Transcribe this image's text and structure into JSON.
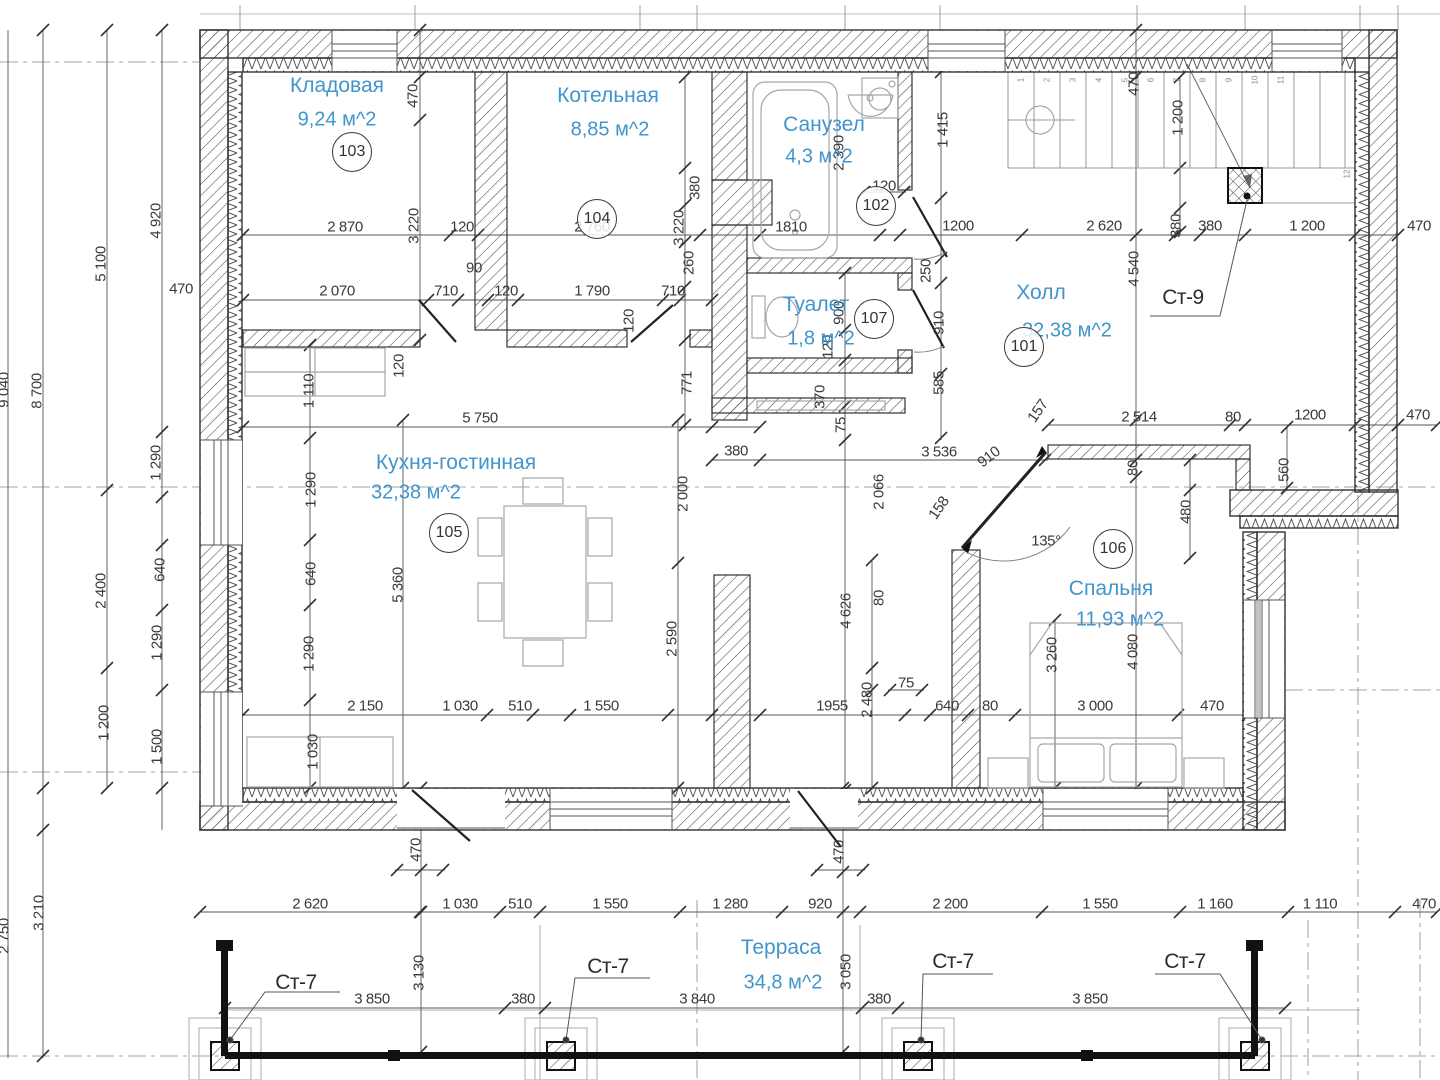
{
  "drawing": {
    "type": "floor-plan",
    "accent_color": "#4195cc",
    "line_color": "#3a3a3a"
  },
  "rooms": [
    {
      "name": "Кладовая",
      "area": "9,24 м^2",
      "number": "103",
      "nx": 337,
      "ny": 86,
      "axx": 337,
      "ay": 120,
      "cx": 352,
      "cy": 152
    },
    {
      "name": "Котельная",
      "area": "8,85 м^2",
      "number": "104",
      "nx": 608,
      "ny": 96,
      "axx": 610,
      "ay": 130,
      "cx": 597,
      "cy": 219
    },
    {
      "name": "Санузел",
      "area": "4,3 м^2",
      "number": "102",
      "nx": 824,
      "ny": 125,
      "axx": 819,
      "ay": 157,
      "cx": 876,
      "cy": 206
    },
    {
      "name": "Туалет",
      "area": "1,8 м^2",
      "number": "107",
      "nx": 816,
      "ny": 305,
      "axx": 821,
      "ay": 339,
      "cx": 874,
      "cy": 319
    },
    {
      "name": "Холл",
      "area": "32,38 м^2",
      "number": "101",
      "nx": 1041,
      "ny": 293,
      "axx": 1067,
      "ay": 331,
      "cx": 1024,
      "cy": 347
    },
    {
      "name": "Кухня-гостинная",
      "area": "32,38 м^2",
      "number": "105",
      "nx": 456,
      "ny": 463,
      "axx": 416,
      "ay": 493,
      "cx": 449,
      "cy": 533
    },
    {
      "name": "Спальня",
      "area": "11,93 м^2",
      "number": "106",
      "nx": 1111,
      "ny": 589,
      "axx": 1120,
      "ay": 620,
      "cx": 1113,
      "cy": 549
    },
    {
      "name": "Терраса",
      "area": "34,8 м^2",
      "number": "",
      "nx": 781,
      "ny": 948,
      "axx": 783,
      "ay": 983,
      "cx": 0,
      "cy": 0
    }
  ],
  "markers": [
    {
      "label": "Ст-9",
      "x": 1183,
      "y": 298
    },
    {
      "label": "Ст-7",
      "x": 296,
      "y": 983
    },
    {
      "label": "Ст-7",
      "x": 608,
      "y": 967
    },
    {
      "label": "Ст-7",
      "x": 953,
      "y": 962
    },
    {
      "label": "Ст-7",
      "x": 1185,
      "y": 962
    }
  ],
  "stair_numbers": [
    "1",
    "2",
    "3",
    "4",
    "5",
    "6",
    "7",
    "8",
    "9",
    "10",
    "11",
    "12"
  ],
  "dims": [
    {
      "t": "2 870",
      "x": 345,
      "y": 227,
      "r": 0
    },
    {
      "t": "120",
      "x": 462,
      "y": 227,
      "r": 0
    },
    {
      "t": "2 760",
      "x": 592,
      "y": 227,
      "r": 0
    },
    {
      "t": "1810",
      "x": 791,
      "y": 227,
      "r": 0
    },
    {
      "t": "120",
      "x": 884,
      "y": 186,
      "r": 0
    },
    {
      "t": "1200",
      "x": 958,
      "y": 226,
      "r": 0
    },
    {
      "t": "2 620",
      "x": 1104,
      "y": 226,
      "r": 0
    },
    {
      "t": "380",
      "x": 1210,
      "y": 226,
      "r": 0
    },
    {
      "t": "1 200",
      "x": 1307,
      "y": 226,
      "r": 0
    },
    {
      "t": "470",
      "x": 1419,
      "y": 226,
      "r": 0
    },
    {
      "t": "470",
      "x": 181,
      "y": 289,
      "r": 0
    },
    {
      "t": "2 070",
      "x": 337,
      "y": 291,
      "r": 0
    },
    {
      "t": "710",
      "x": 446,
      "y": 291,
      "r": 0
    },
    {
      "t": "90",
      "x": 474,
      "y": 268,
      "r": 0
    },
    {
      "t": "120",
      "x": 506,
      "y": 291,
      "r": 0
    },
    {
      "t": "1 790",
      "x": 592,
      "y": 291,
      "r": 0
    },
    {
      "t": "710",
      "x": 673,
      "y": 291,
      "r": 0
    },
    {
      "t": "5 750",
      "x": 480,
      "y": 418,
      "r": 0
    },
    {
      "t": "380",
      "x": 736,
      "y": 451,
      "r": 0
    },
    {
      "t": "2 514",
      "x": 1139,
      "y": 417,
      "r": 0
    },
    {
      "t": "80",
      "x": 1233,
      "y": 417,
      "r": 0
    },
    {
      "t": "1200",
      "x": 1310,
      "y": 415,
      "r": 0
    },
    {
      "t": "470",
      "x": 1418,
      "y": 415,
      "r": 0
    },
    {
      "t": "3 536",
      "x": 939,
      "y": 452,
      "r": 0
    },
    {
      "t": "135°",
      "x": 1046,
      "y": 541,
      "r": 0
    },
    {
      "t": "2 150",
      "x": 365,
      "y": 706,
      "r": 0
    },
    {
      "t": "1 030",
      "x": 460,
      "y": 706,
      "r": 0
    },
    {
      "t": "510",
      "x": 520,
      "y": 706,
      "r": 0
    },
    {
      "t": "1 550",
      "x": 601,
      "y": 706,
      "r": 0
    },
    {
      "t": "1955",
      "x": 832,
      "y": 706,
      "r": 0
    },
    {
      "t": "75",
      "x": 906,
      "y": 683,
      "r": 0
    },
    {
      "t": "640",
      "x": 947,
      "y": 706,
      "r": 0
    },
    {
      "t": "80",
      "x": 990,
      "y": 706,
      "r": 0
    },
    {
      "t": "3 000",
      "x": 1095,
      "y": 706,
      "r": 0
    },
    {
      "t": "470",
      "x": 1212,
      "y": 706,
      "r": 0
    },
    {
      "t": "2 620",
      "x": 310,
      "y": 904,
      "r": 0
    },
    {
      "t": "1 030",
      "x": 460,
      "y": 904,
      "r": 0
    },
    {
      "t": "510",
      "x": 520,
      "y": 904,
      "r": 0
    },
    {
      "t": "1 550",
      "x": 610,
      "y": 904,
      "r": 0
    },
    {
      "t": "1 280",
      "x": 730,
      "y": 904,
      "r": 0
    },
    {
      "t": "920",
      "x": 820,
      "y": 904,
      "r": 0
    },
    {
      "t": "2 200",
      "x": 950,
      "y": 904,
      "r": 0
    },
    {
      "t": "1 550",
      "x": 1100,
      "y": 904,
      "r": 0
    },
    {
      "t": "1 160",
      "x": 1215,
      "y": 904,
      "r": 0
    },
    {
      "t": "1 110",
      "x": 1320,
      "y": 904,
      "r": 0
    },
    {
      "t": "470",
      "x": 1424,
      "y": 904,
      "r": 0
    },
    {
      "t": "3 850",
      "x": 372,
      "y": 999,
      "r": 0
    },
    {
      "t": "380",
      "x": 523,
      "y": 999,
      "r": 0
    },
    {
      "t": "3 840",
      "x": 697,
      "y": 999,
      "r": 0
    },
    {
      "t": "380",
      "x": 879,
      "y": 999,
      "r": 0
    },
    {
      "t": "3 850",
      "x": 1090,
      "y": 999,
      "r": 0
    },
    {
      "t": "470",
      "x": 413,
      "y": 96,
      "r": -90
    },
    {
      "t": "3 220",
      "x": 414,
      "y": 226,
      "r": -90
    },
    {
      "t": "1 110",
      "x": 309,
      "y": 391,
      "r": -90
    },
    {
      "t": "120",
      "x": 399,
      "y": 366,
      "r": -90
    },
    {
      "t": "3 220",
      "x": 679,
      "y": 228,
      "r": -90
    },
    {
      "t": "380",
      "x": 695,
      "y": 188,
      "r": -90
    },
    {
      "t": "260",
      "x": 689,
      "y": 263,
      "r": -90
    },
    {
      "t": "120",
      "x": 629,
      "y": 321,
      "r": -90
    },
    {
      "t": "771",
      "x": 687,
      "y": 383,
      "r": -90
    },
    {
      "t": "4 920",
      "x": 156,
      "y": 221,
      "r": -90
    },
    {
      "t": "5 100",
      "x": 101,
      "y": 264,
      "r": -90
    },
    {
      "t": "8 700",
      "x": 37,
      "y": 391,
      "r": -90
    },
    {
      "t": "9 040",
      "x": 4,
      "y": 390,
      "r": -90
    },
    {
      "t": "2 390",
      "x": 839,
      "y": 153,
      "r": -90
    },
    {
      "t": "1 415",
      "x": 943,
      "y": 130,
      "r": -90
    },
    {
      "t": "250",
      "x": 926,
      "y": 271,
      "r": -90
    },
    {
      "t": "910",
      "x": 939,
      "y": 323,
      "r": -90
    },
    {
      "t": "585",
      "x": 939,
      "y": 383,
      "r": -90
    },
    {
      "t": "470",
      "x": 1134,
      "y": 84,
      "r": -90
    },
    {
      "t": "1 200",
      "x": 1178,
      "y": 118,
      "r": -90
    },
    {
      "t": "380",
      "x": 1176,
      "y": 226,
      "r": -90
    },
    {
      "t": "4 540",
      "x": 1134,
      "y": 269,
      "r": -90
    },
    {
      "t": "370",
      "x": 820,
      "y": 397,
      "r": -90
    },
    {
      "t": "75",
      "x": 841,
      "y": 425,
      "r": -90
    },
    {
      "t": "900",
      "x": 839,
      "y": 313,
      "r": -90
    },
    {
      "t": "120",
      "x": 828,
      "y": 347,
      "r": -90
    },
    {
      "t": "2 000",
      "x": 683,
      "y": 494,
      "r": -90
    },
    {
      "t": "2 590",
      "x": 672,
      "y": 639,
      "r": -90
    },
    {
      "t": "5 360",
      "x": 398,
      "y": 585,
      "r": -90
    },
    {
      "t": "1 290",
      "x": 311,
      "y": 490,
      "r": -90
    },
    {
      "t": "640",
      "x": 311,
      "y": 574,
      "r": -90
    },
    {
      "t": "1 290",
      "x": 309,
      "y": 654,
      "r": -90
    },
    {
      "t": "1 030",
      "x": 313,
      "y": 752,
      "r": -90
    },
    {
      "t": "1 290",
      "x": 156,
      "y": 463,
      "r": -90
    },
    {
      "t": "640",
      "x": 160,
      "y": 570,
      "r": -90
    },
    {
      "t": "1 290",
      "x": 157,
      "y": 643,
      "r": -90
    },
    {
      "t": "2 400",
      "x": 101,
      "y": 591,
      "r": -90
    },
    {
      "t": "1 200",
      "x": 104,
      "y": 723,
      "r": -90
    },
    {
      "t": "1 500",
      "x": 157,
      "y": 747,
      "r": -90
    },
    {
      "t": "3 210",
      "x": 39,
      "y": 913,
      "r": -90
    },
    {
      "t": "2 750",
      "x": 4,
      "y": 936,
      "r": -90
    },
    {
      "t": "2 066",
      "x": 879,
      "y": 492,
      "r": -90
    },
    {
      "t": "80",
      "x": 879,
      "y": 598,
      "r": -90
    },
    {
      "t": "4 626",
      "x": 846,
      "y": 611,
      "r": -90
    },
    {
      "t": "2 480",
      "x": 867,
      "y": 700,
      "r": -90
    },
    {
      "t": "80",
      "x": 1133,
      "y": 468,
      "r": -90
    },
    {
      "t": "560",
      "x": 1284,
      "y": 470,
      "r": -90
    },
    {
      "t": "480",
      "x": 1186,
      "y": 512,
      "r": -90
    },
    {
      "t": "3 260",
      "x": 1052,
      "y": 655,
      "r": -90
    },
    {
      "t": "4 080",
      "x": 1133,
      "y": 652,
      "r": -90
    },
    {
      "t": "470",
      "x": 416,
      "y": 850,
      "r": -90
    },
    {
      "t": "470",
      "x": 839,
      "y": 852,
      "r": -90
    },
    {
      "t": "3 130",
      "x": 419,
      "y": 973,
      "r": -90
    },
    {
      "t": "3 050",
      "x": 846,
      "y": 972,
      "r": -90
    },
    {
      "t": "157",
      "x": 1038,
      "y": 411,
      "r": -55
    },
    {
      "t": "910",
      "x": 989,
      "y": 457,
      "r": -38
    },
    {
      "t": "158",
      "x": 939,
      "y": 508,
      "r": -55
    }
  ]
}
